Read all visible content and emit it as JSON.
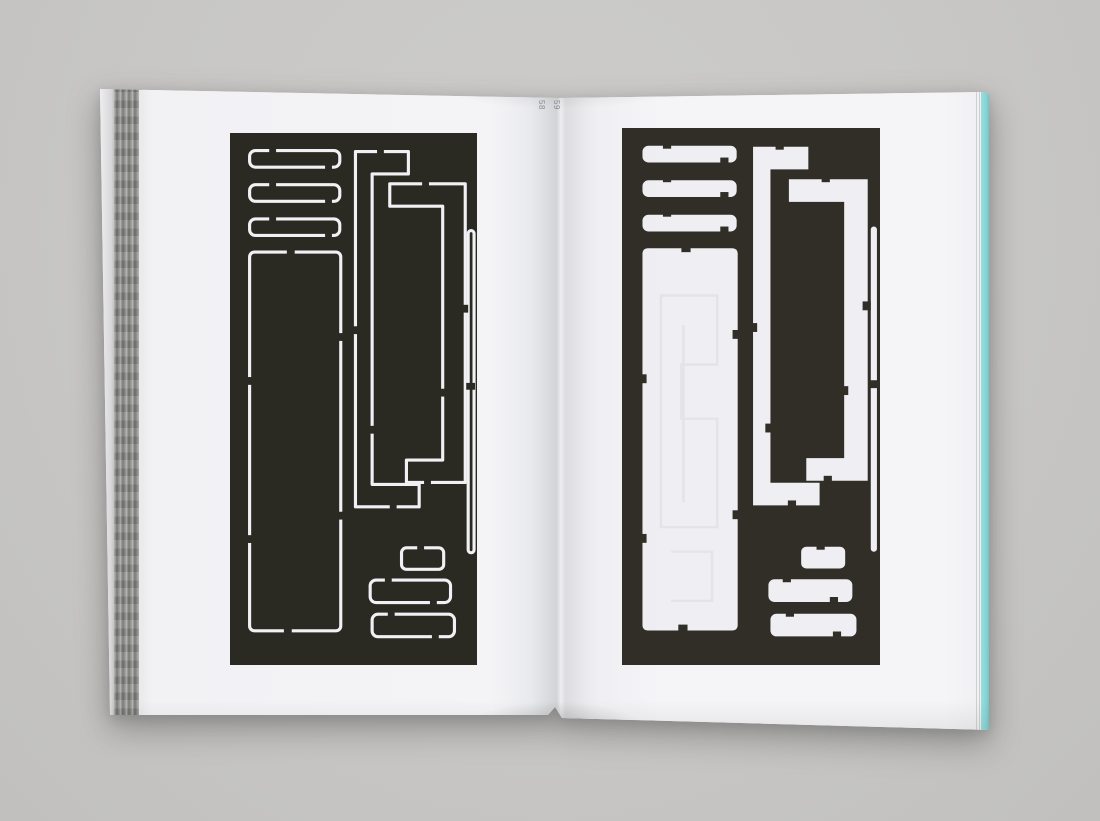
{
  "scene": {
    "type": "photograph",
    "subject": "Open book spread showing a die-cut stencil plate: cut-line outline version on the left page, punched-out version on the right page",
    "background_color": "#c8c7c5"
  },
  "book": {
    "left_page": {
      "page_number": "58",
      "artwork": {
        "name": "die-cut plate, outline (score lines) version",
        "panel_color": "#2b2a22",
        "cut_line_color": "#f1f1f5"
      }
    },
    "right_page": {
      "page_number": "59",
      "artwork": {
        "name": "die-cut plate, punched-out version",
        "panel_color": "#302e26",
        "cutout_color": "#efeff3"
      }
    },
    "fore_edge_color": "#84d4d3",
    "page_stack_color": "#8f8f8d"
  }
}
